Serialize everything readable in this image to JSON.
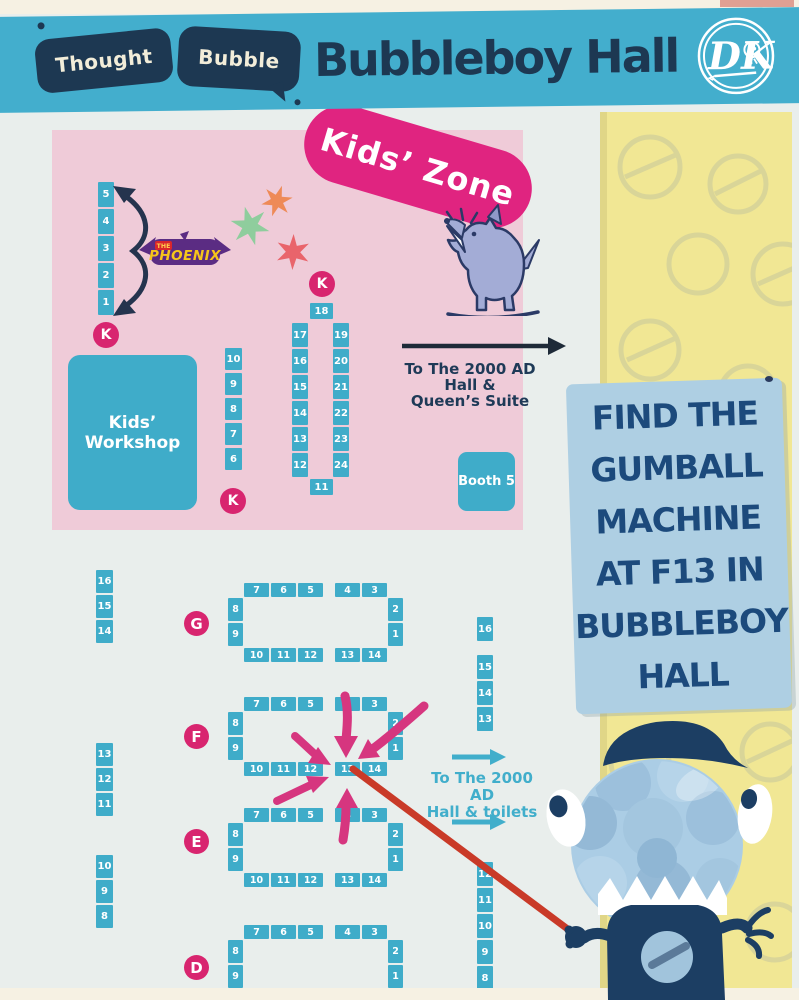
{
  "header": {
    "brand": {
      "bubble1": "Thought",
      "bubble2": "Bubble"
    },
    "title": "Bubbleboy Hall",
    "publisher_logo": "DK"
  },
  "kids_zone": {
    "banner": "Kids’ Zone",
    "phoenix": {
      "prefix": "THE",
      "name": "PHOENIX"
    },
    "workshop_lines": [
      "Kids’",
      "Workshop"
    ],
    "kids_marker": "K",
    "col_a": [
      "5",
      "4",
      "3",
      "2",
      "1"
    ],
    "col_b": [
      "10",
      "9",
      "8",
      "7",
      "6"
    ],
    "island": {
      "top": "18",
      "left": [
        "17",
        "16",
        "15",
        "14",
        "13",
        "12"
      ],
      "right": [
        "19",
        "20",
        "21",
        "22",
        "23",
        "24"
      ],
      "bottom": "11"
    },
    "exit_lines": [
      "To The 2000 AD",
      "Hall &",
      "Queen’s Suite"
    ],
    "booth5": "Booth 5"
  },
  "main_hall": {
    "left_col_1": [
      "16",
      "15",
      "14"
    ],
    "left_col_2": [
      "13",
      "12",
      "11"
    ],
    "left_col_3": [
      "10",
      "9",
      "8"
    ],
    "right_col_upper": [
      "16"
    ],
    "right_col_mid": [
      "15",
      "14",
      "13"
    ],
    "right_col_lower": [
      "12",
      "11",
      "10",
      "9",
      "8"
    ],
    "exit_lines": [
      "To The 2000 AD",
      "Hall & toilets"
    ],
    "rows": [
      {
        "label": "G",
        "top_l": [
          "7",
          "6",
          "5"
        ],
        "top_r": [
          "4",
          "3"
        ],
        "left": [
          "8",
          "9"
        ],
        "right": [
          "2",
          "1"
        ],
        "bot_l": [
          "10",
          "11",
          "12"
        ],
        "bot_r": [
          "13",
          "14"
        ]
      },
      {
        "label": "F",
        "top_l": [
          "7",
          "6",
          "5"
        ],
        "top_r": [
          "4",
          "3"
        ],
        "left": [
          "8",
          "9"
        ],
        "right": [
          "2",
          "1"
        ],
        "bot_l": [
          "10",
          "11",
          "12"
        ],
        "bot_r": [
          "13",
          "14"
        ]
      },
      {
        "label": "E",
        "top_l": [
          "7",
          "6",
          "5"
        ],
        "top_r": [
          "4",
          "3"
        ],
        "left": [
          "8",
          "9"
        ],
        "right": [
          "2",
          "1"
        ],
        "bot_l": [
          "10",
          "11",
          "12"
        ],
        "bot_r": [
          "13",
          "14"
        ]
      },
      {
        "label": "D",
        "top_l": [
          "7",
          "6",
          "5"
        ],
        "top_r": [
          "4",
          "3"
        ],
        "left": [
          "8",
          "9"
        ],
        "right": [
          "2",
          "1"
        ],
        "bot_l": [],
        "bot_r": []
      }
    ]
  },
  "callout": {
    "lines": [
      "FIND THE",
      "GUMBALL",
      "MACHINE",
      "AT F13 IN",
      "BUBBLEBOY",
      "HALL"
    ],
    "target_booth": "F13"
  },
  "icons": {
    "publisher_badge": "dk-circle-logo",
    "kids_mascot": "barking-dog-icon",
    "gumball_mascot": "gumball-machine-monster-icon",
    "stars": "decorative-stars",
    "pointer": "red-pointer-stick"
  },
  "colors": {
    "header_teal": "#43AECD",
    "navy": "#1D3852",
    "booth_teal": "#3FACC9",
    "kids_pink_bg": "#EFCBD8",
    "magenta": "#D8256F",
    "banner_pink": "#E02480",
    "arrow_pink": "#D6367F",
    "panel_blue": "#AECFE3",
    "panel_text": "#1C4A7C",
    "yellow_strip": "#F1E794",
    "hall_bg": "#E9EEEC",
    "page_cream": "#F6F1E3",
    "pointer_red": "#C93A28",
    "phoenix_purple": "#5B2C83",
    "phoenix_yellow": "#F6C61A"
  }
}
